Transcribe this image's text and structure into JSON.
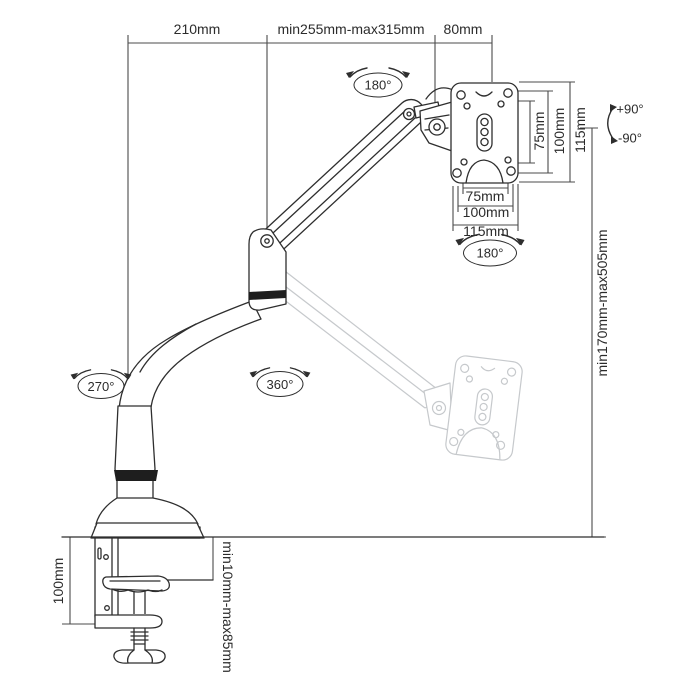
{
  "labels": {
    "top_width_left": "210mm",
    "top_width_middle": "min255mm-max315mm",
    "top_width_right": "80mm",
    "vesa_vertical": {
      "inner": "75mm",
      "middle": "100mm",
      "outer": "115mm"
    },
    "vesa_horizontal": {
      "inner": "75mm",
      "middle": "100mm",
      "outer": "115mm"
    },
    "height_range": "min170mm-max505mm",
    "clamp_height": "100mm",
    "desk_thickness_range": "min10mm-max85mm",
    "rotation": {
      "head_swivel_top": "180°",
      "head_swivel_bottom": "180°",
      "base_swivel": "270°",
      "elbow_swivel": "360°",
      "tilt_up": "+90°",
      "tilt_down": "-90°"
    }
  },
  "colors": {
    "background": "#ffffff",
    "line": "#2e2e2e",
    "dimension": "#4b4b4b",
    "ghost": "#c6c9cc",
    "dark_fill": "#1e1e1e",
    "text": "#2b2b2b"
  }
}
